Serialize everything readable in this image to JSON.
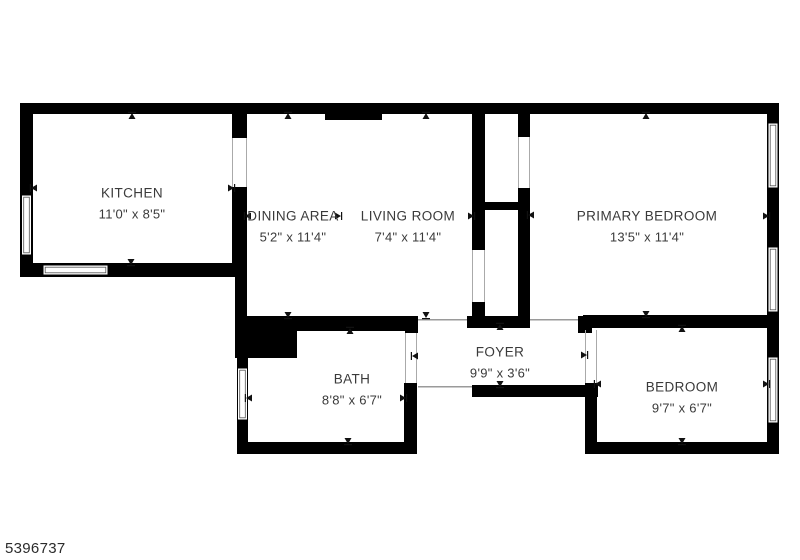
{
  "plan_id": "5396737",
  "rooms": [
    {
      "id": "kitchen",
      "name": "KITCHEN",
      "dims": "11'0\" x 8'5\""
    },
    {
      "id": "dining-area",
      "name": "DINING AREA",
      "dims": "5'2\" x 11'4\""
    },
    {
      "id": "living-room",
      "name": "LIVING ROOM",
      "dims": "7'4\" x 11'4\""
    },
    {
      "id": "primary-bedroom",
      "name": "PRIMARY BEDROOM",
      "dims": "13'5\" x 11'4\""
    },
    {
      "id": "foyer",
      "name": "FOYER",
      "dims": "9'9\" x 3'6\""
    },
    {
      "id": "bath",
      "name": "BATH",
      "dims": "8'8\" x 6'7\""
    },
    {
      "id": "bedroom",
      "name": "BEDROOM",
      "dims": "9'7\" x 6'7\""
    }
  ],
  "colors": {
    "wall": "#000000",
    "background": "#ffffff",
    "text": "#3a3a3a",
    "opening_line": "#9a9a9a",
    "window_inner": "#555555"
  },
  "markers": [
    {
      "room": "kitchen",
      "dir": "up",
      "x": 132,
      "y": 113
    },
    {
      "room": "kitchen",
      "dir": "down",
      "x": 131,
      "y": 265
    },
    {
      "room": "kitchen",
      "dir": "left",
      "x": 31,
      "y": 188
    },
    {
      "room": "kitchen",
      "dir": "right",
      "x": 234,
      "y": 188
    },
    {
      "room": "dining-area",
      "dir": "up",
      "x": 288,
      "y": 113
    },
    {
      "room": "dining-area",
      "dir": "down",
      "x": 288,
      "y": 318
    },
    {
      "room": "dining-area",
      "dir": "left",
      "x": 245,
      "y": 216
    },
    {
      "room": "dining-area",
      "dir": "right",
      "x": 341,
      "y": 216
    },
    {
      "room": "living-room",
      "dir": "up",
      "x": 426,
      "y": 113
    },
    {
      "room": "living-room",
      "dir": "down",
      "x": 426,
      "y": 318
    },
    {
      "room": "living-room",
      "dir": "right",
      "x": 474,
      "y": 216
    },
    {
      "room": "primary-bedroom",
      "dir": "up",
      "x": 646,
      "y": 113
    },
    {
      "room": "primary-bedroom",
      "dir": "down",
      "x": 646,
      "y": 317
    },
    {
      "room": "primary-bedroom",
      "dir": "left",
      "x": 528,
      "y": 215
    },
    {
      "room": "primary-bedroom",
      "dir": "right",
      "x": 769,
      "y": 216
    },
    {
      "room": "foyer",
      "dir": "up",
      "x": 500,
      "y": 324
    },
    {
      "room": "foyer",
      "dir": "down",
      "x": 500,
      "y": 387
    },
    {
      "room": "foyer",
      "dir": "left",
      "x": 412,
      "y": 356
    },
    {
      "room": "foyer",
      "dir": "right",
      "x": 587,
      "y": 355
    },
    {
      "room": "bath",
      "dir": "up",
      "x": 350,
      "y": 328
    },
    {
      "room": "bath",
      "dir": "down",
      "x": 348,
      "y": 444
    },
    {
      "room": "bath",
      "dir": "left",
      "x": 246,
      "y": 398
    },
    {
      "room": "bath",
      "dir": "right",
      "x": 406,
      "y": 398
    },
    {
      "room": "bedroom",
      "dir": "up",
      "x": 682,
      "y": 326
    },
    {
      "room": "bedroom",
      "dir": "down",
      "x": 682,
      "y": 444
    },
    {
      "room": "bedroom",
      "dir": "left",
      "x": 595,
      "y": 384
    },
    {
      "room": "bedroom",
      "dir": "right",
      "x": 769,
      "y": 384
    }
  ]
}
